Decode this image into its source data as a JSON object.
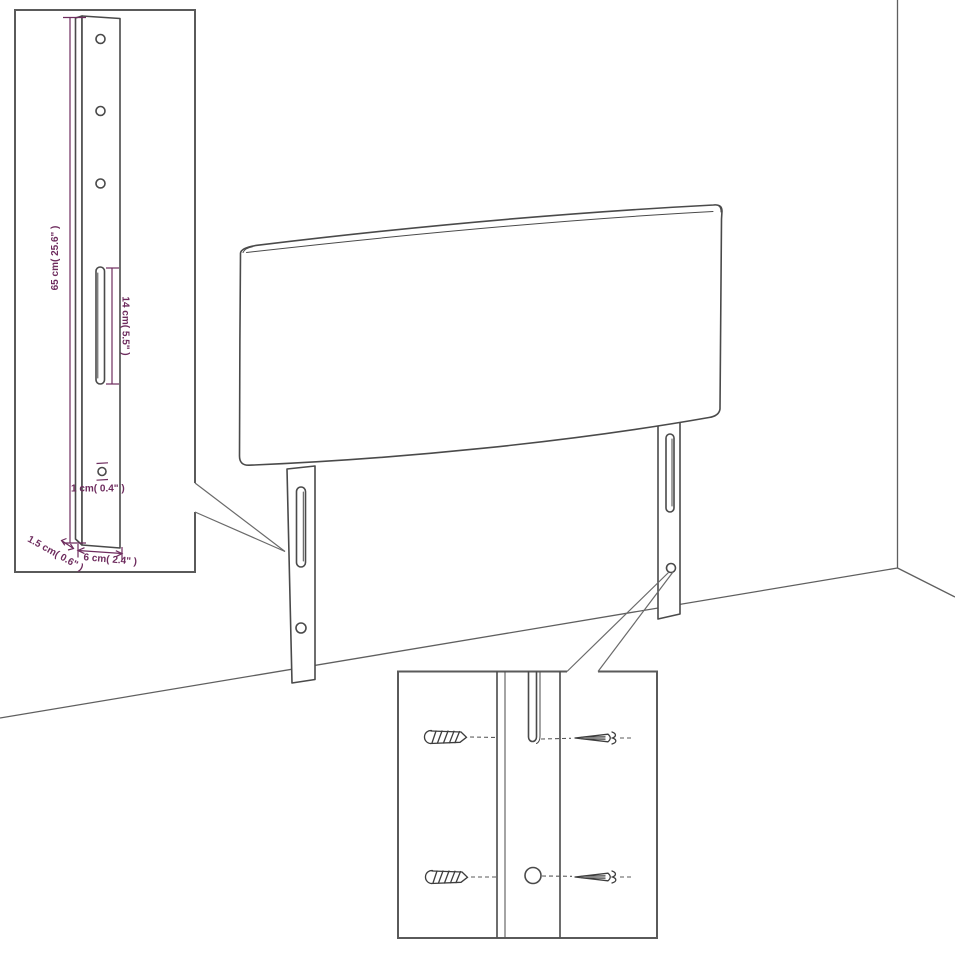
{
  "diagram": {
    "type": "furniture-dimension-diagram",
    "subject": "upholstered headboard with two slotted mounting legs, wall-corner backdrop, leg dimension inset and screw mounting detail inset",
    "colors": {
      "background": "#ffffff",
      "line": "#4a4a4a",
      "dimension": "#6e2c5e",
      "inset_border": "#5a5a5a"
    },
    "labels": {
      "leg_height": "65 cm( 25.6\" )",
      "slot_height": "14 cm( 5.5\" )",
      "hole_diameter": "1 cm( 0.4\" )",
      "leg_thickness": "1.5 cm( 0.6\" )",
      "leg_width": "6 cm( 2.4\" )"
    }
  }
}
